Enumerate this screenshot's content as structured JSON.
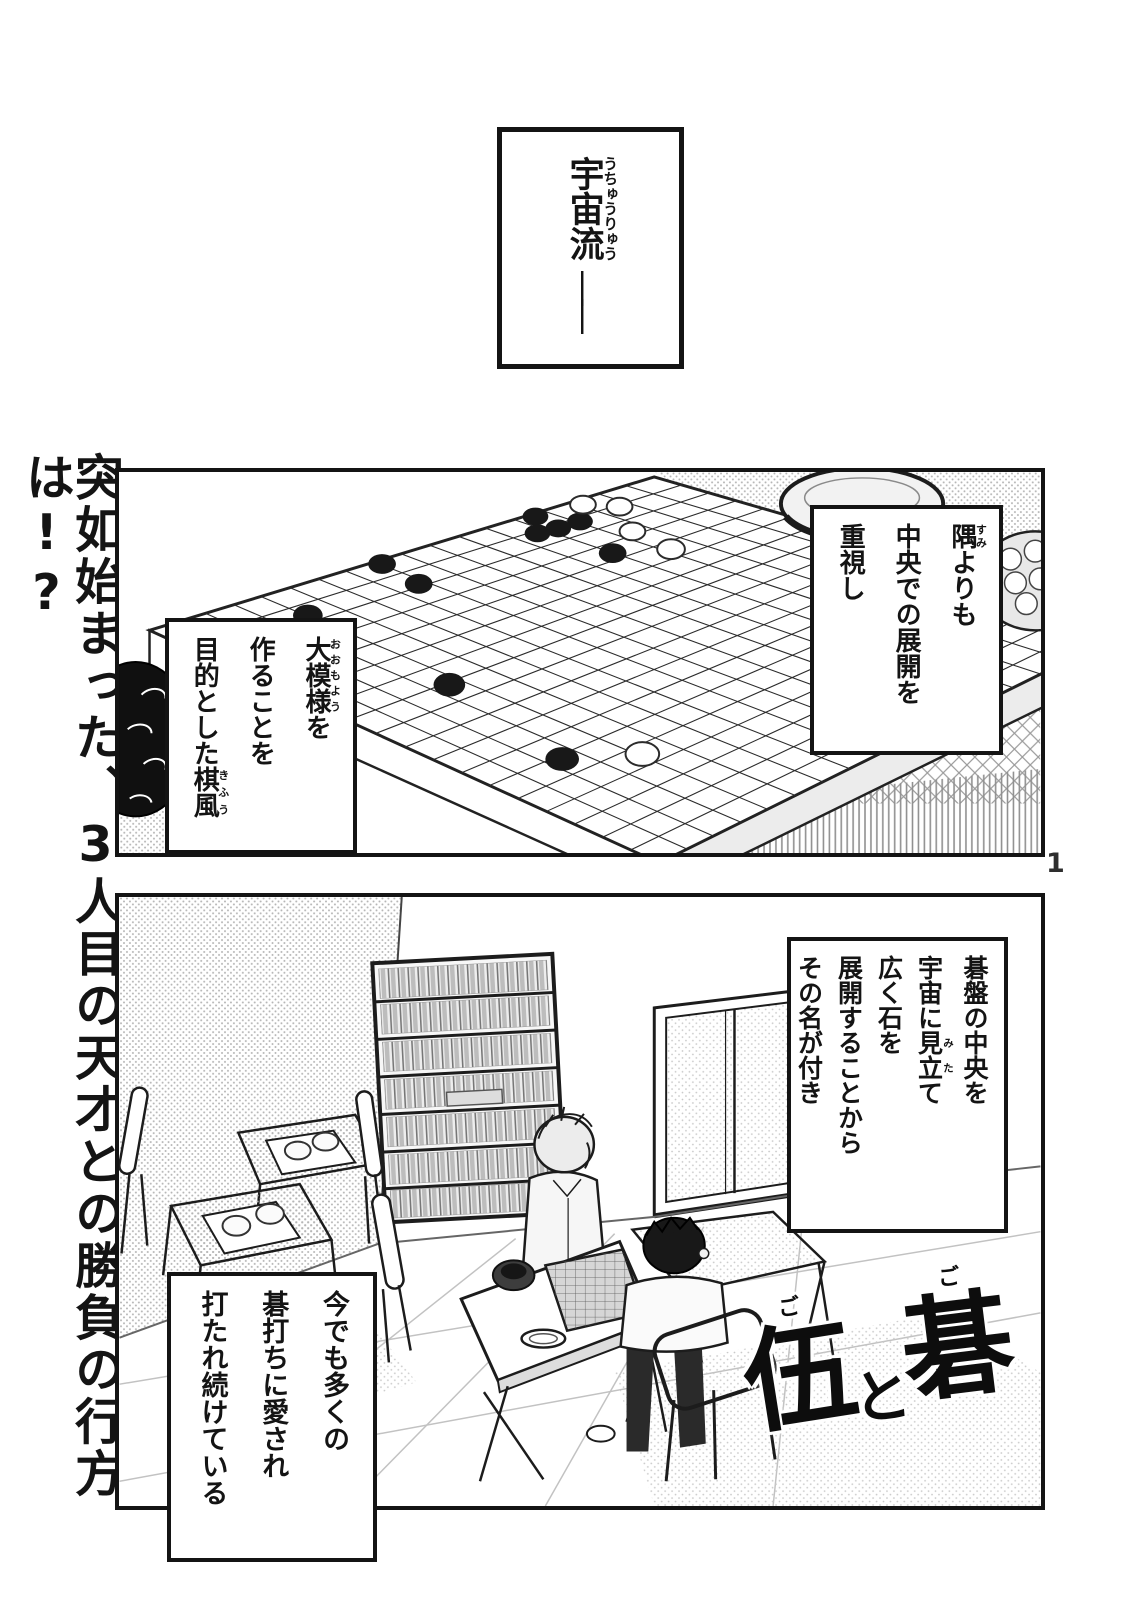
{
  "page": {
    "number": "1"
  },
  "colors": {
    "ink": "#141414",
    "paper": "#ffffff",
    "tone_gray": "#b9b9b9"
  },
  "margin_tagline": "突如始まった、3人目の天才との勝負の行方は!?",
  "top_box": {
    "segs": [
      {
        "t": "宇宙流",
        "r": "うちゅうりゅう"
      }
    ],
    "dash": "――"
  },
  "panel1": {
    "box_right": {
      "lines": [
        {
          "segs": [
            {
              "t": "隅",
              "r": "すみ"
            },
            {
              "t": "よりも"
            }
          ]
        },
        {
          "segs": [
            {
              "t": "中央での展開を"
            }
          ]
        },
        {
          "segs": [
            {
              "t": "重視し"
            }
          ]
        }
      ]
    },
    "box_left": {
      "lines": [
        {
          "segs": [
            {
              "t": "大模様",
              "r": "おおもよう"
            },
            {
              "t": "を"
            }
          ]
        },
        {
          "segs": [
            {
              "t": "作ることを"
            }
          ]
        },
        {
          "segs": [
            {
              "t": "目的とした"
            },
            {
              "t": "棋風",
              "r": "きふう"
            }
          ]
        }
      ]
    }
  },
  "panel2": {
    "box_right": {
      "lines": [
        {
          "segs": [
            {
              "t": "碁盤の中央を"
            }
          ]
        },
        {
          "segs": [
            {
              "t": "宇宙に"
            },
            {
              "t": "見立",
              "r": "みた"
            },
            {
              "t": "て"
            }
          ]
        },
        {
          "segs": [
            {
              "t": "広く石を"
            }
          ]
        },
        {
          "segs": [
            {
              "t": "展開することから"
            }
          ]
        },
        {
          "segs": [
            {
              "t": "その名が付き"
            }
          ]
        }
      ]
    },
    "box_left": {
      "lines": [
        {
          "segs": [
            {
              "t": "今でも多くの"
            }
          ]
        },
        {
          "segs": [
            {
              "t": "碁打ちに愛され"
            }
          ]
        },
        {
          "segs": [
            {
              "t": "打たれ続けている"
            }
          ]
        }
      ]
    }
  },
  "title_logo": {
    "chars": [
      {
        "t": "伍",
        "r": "ご"
      },
      {
        "t": "と"
      },
      {
        "t": "碁",
        "r": "ご"
      }
    ]
  }
}
